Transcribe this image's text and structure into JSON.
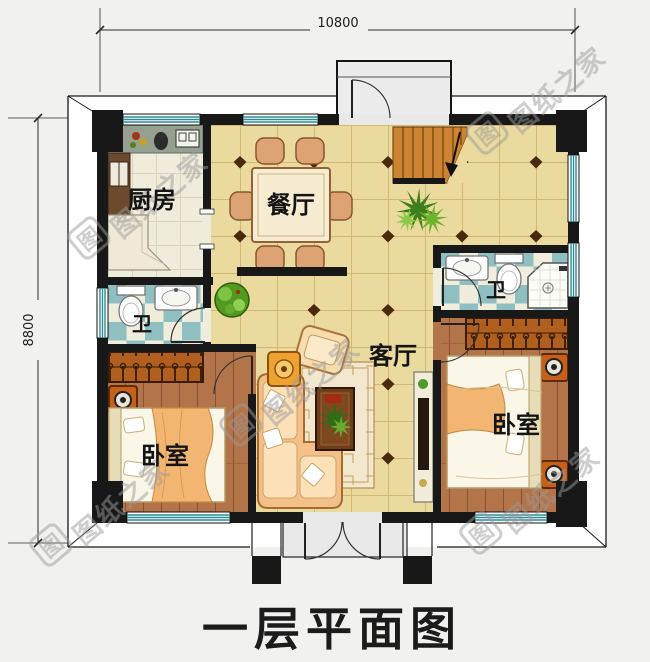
{
  "title": "一层平面图",
  "dimensions": {
    "width": "10800",
    "height": "8800"
  },
  "rooms": {
    "kitchen": "厨房",
    "dining": "餐厅",
    "living": "客厅",
    "bath_left": "卫",
    "bath_right": "卫",
    "bedroom_left": "卧室",
    "bedroom_right": "卧室"
  },
  "watermark": {
    "logo": "图",
    "text": "图纸之家"
  },
  "colors": {
    "wall": "#181818",
    "floor_tile": "#eada9e",
    "kitchen_tile": "#f0ecdc",
    "wood_floor": "#b3744a",
    "bath_teal": "#8fbfc0",
    "bath_cream": "#f1eddc",
    "stair_wood": "#cd8432",
    "furniture_orange": "#f3c089",
    "accent_rust": "#c65f17",
    "window_teal": "#2f8a94",
    "watermark_gray": "#9a9a9a"
  }
}
